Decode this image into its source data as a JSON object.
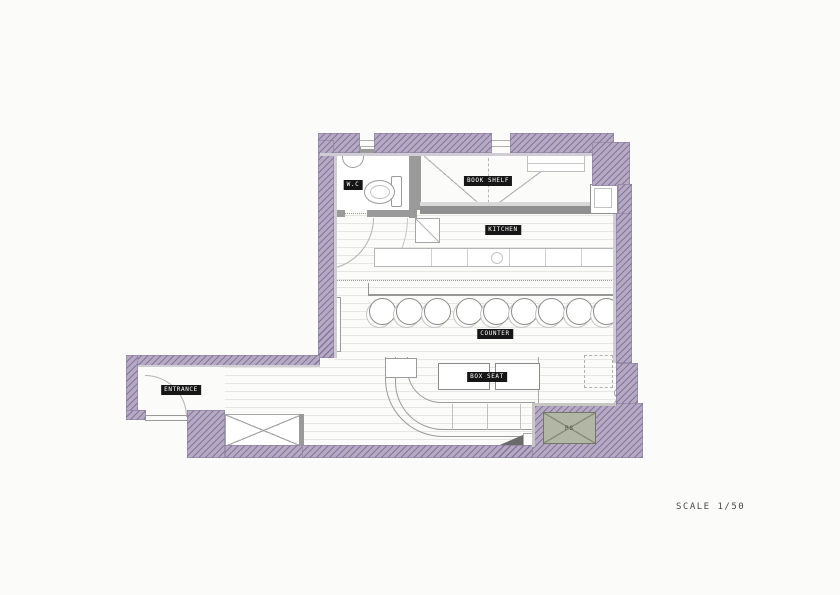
{
  "document": {
    "type": "architectural floor plan",
    "drawing_style": "scanned technical drawing, hatched walls"
  },
  "plan": {
    "labels": {
      "wc": "W.C",
      "book_shelf": "BOOK SHELF",
      "kitchen": "KITCHEN",
      "counter": "COUNTER",
      "box_seat": "BOX SEAT",
      "entrance": "ENTRANCE",
      "pipe_space": "PS"
    },
    "scale_text": "SCALE 1/50",
    "stools": {
      "count": 9,
      "centers_x": [
        382,
        409,
        437,
        469,
        496,
        524,
        551,
        579,
        606
      ],
      "center_y": 311,
      "diameter": 27
    },
    "colors": {
      "wall_fill": "#b6aac3",
      "wall_hatch": "#84759f",
      "partition": "#9a9a9a",
      "pipe_space_fill": "#b2b7a5",
      "label_bg": "#161616",
      "label_text": "#ffffff",
      "line": "#999999"
    }
  }
}
